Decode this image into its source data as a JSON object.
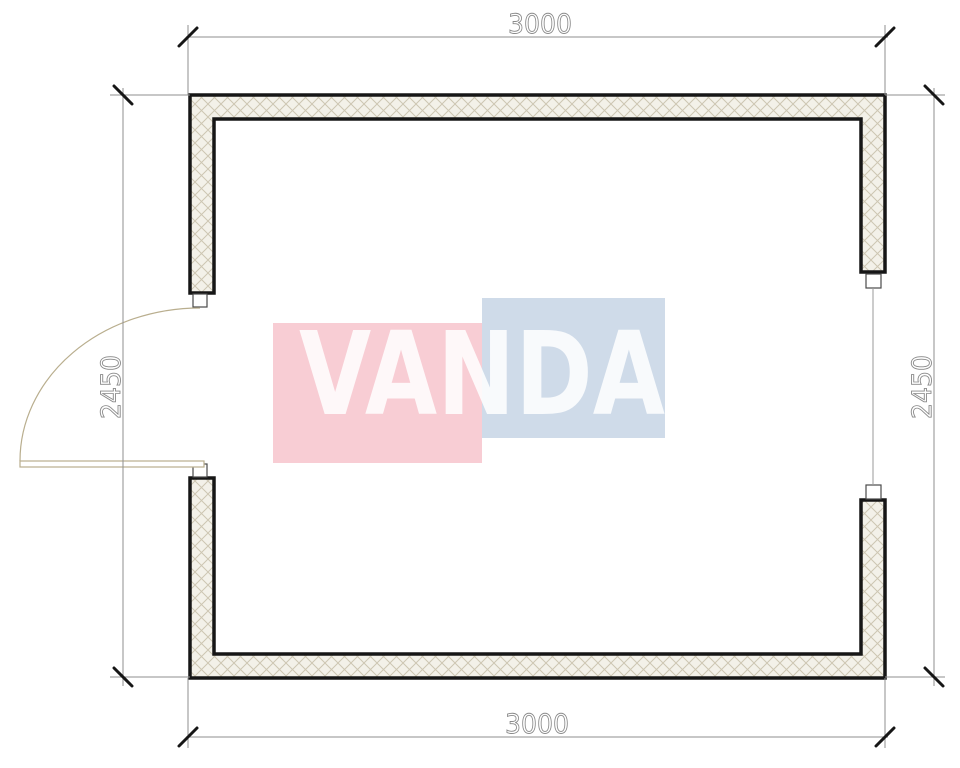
{
  "plan": {
    "watermark": {
      "text": "VANDA",
      "pink_color": "#f8cdd4",
      "blue_color": "#cfdbe9",
      "text_color": "rgba(255,255,255,0.85)"
    },
    "dimensions": {
      "top": "3000",
      "bottom": "3000",
      "left": "2450",
      "right": "2450"
    },
    "colors": {
      "wall_stroke": "#161616",
      "hatch_bg": "#f3f1e9",
      "hatch_line": "#cdc6b2",
      "dim_line": "#8f8f8f",
      "dim_text": "#8a8a8a",
      "tick": "#161616",
      "door": "#b9ae8e",
      "jamb_stroke": "#4a4a4a",
      "glazing": "#9a9a9a"
    }
  }
}
